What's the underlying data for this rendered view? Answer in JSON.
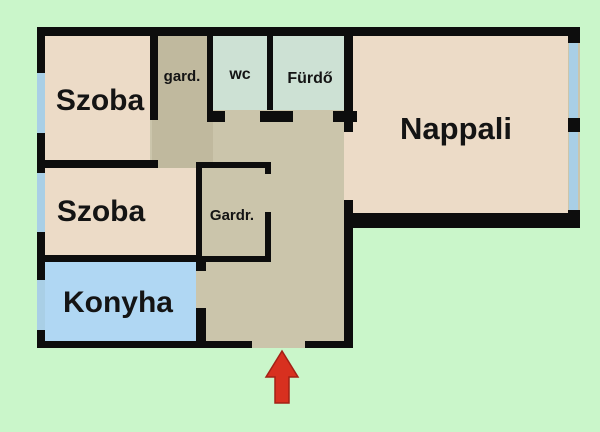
{
  "floorplan": {
    "colors": {
      "bg": "#caf6ca",
      "wall": "#0d0d0d",
      "window": "#a9cfe6",
      "beige": "#ecdbc7",
      "tan": "#cbc5ab",
      "tanDark": "#c0b99e",
      "mint": "#cde1d4",
      "blue": "#b0d7f3",
      "arrow": "#d8301f",
      "arrowEdge": "#a32015"
    },
    "rooms": [
      {
        "id": "szoba-1",
        "label": "Szoba"
      },
      {
        "id": "szoba-2",
        "label": "Szoba"
      },
      {
        "id": "konyha",
        "label": "Konyha"
      },
      {
        "id": "gard",
        "label": "gard."
      },
      {
        "id": "wc",
        "label": "wc"
      },
      {
        "id": "furdo",
        "label": "Fürdő"
      },
      {
        "id": "nappali",
        "label": "Nappali"
      },
      {
        "id": "gardr",
        "label": "Gardr."
      }
    ],
    "entrance": {
      "marker": "entrance-arrow-up"
    }
  }
}
